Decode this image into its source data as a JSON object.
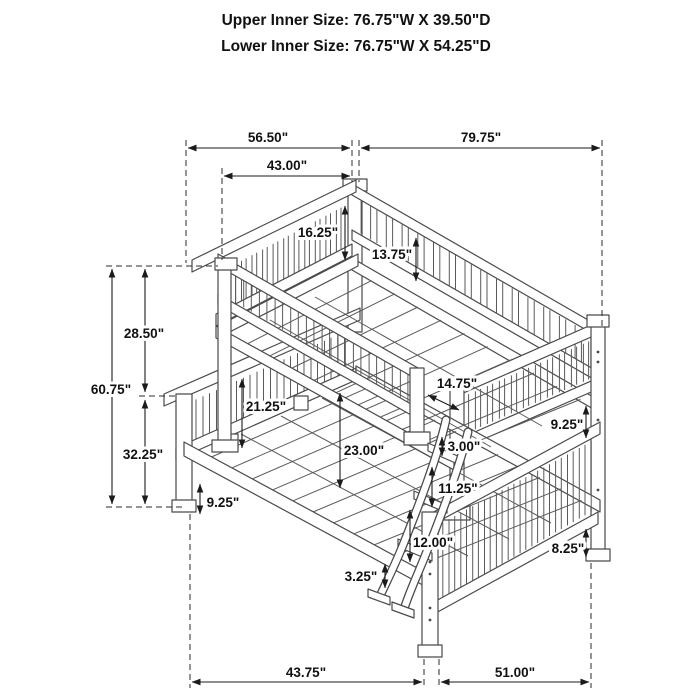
{
  "title": {
    "line1": "Upper Inner Size: 76.75\"W X 39.50\"D",
    "line2": "Lower Inner Size: 76.75\"W X 54.25\"D"
  },
  "product": "twin over full bunk bed dimension diagram",
  "dimensions": {
    "upper_head_span": "56.50\"",
    "upper_length_span": "79.75\"",
    "upper_inner_span": "43.00\"",
    "headboard_to_deck": "16.25\"",
    "rail_to_deck": "13.75\"",
    "upper_section_height": "28.50\"",
    "total_height": "60.75\"",
    "lower_section_height": "32.25\"",
    "left_leg_clearance": "9.25\"",
    "guardrail_height": "21.25\"",
    "deck_to_deck": "23.00\"",
    "post_offset": "14.75\"",
    "ladder_top_gap": "3.00\"",
    "rung_gap_upper": "11.25\"",
    "rung_gap_lower": "12.00\"",
    "ladder_foot_height": "3.25\"",
    "right_rail_gap": "9.25\"",
    "right_leg_height": "8.25\"",
    "lower_depth_span": "43.75\"",
    "lower_length_span": "51.00\""
  },
  "colors": {
    "line_work": "#4a4a4a",
    "dimension_ink": "#1b1b1b",
    "background": "#ffffff"
  }
}
